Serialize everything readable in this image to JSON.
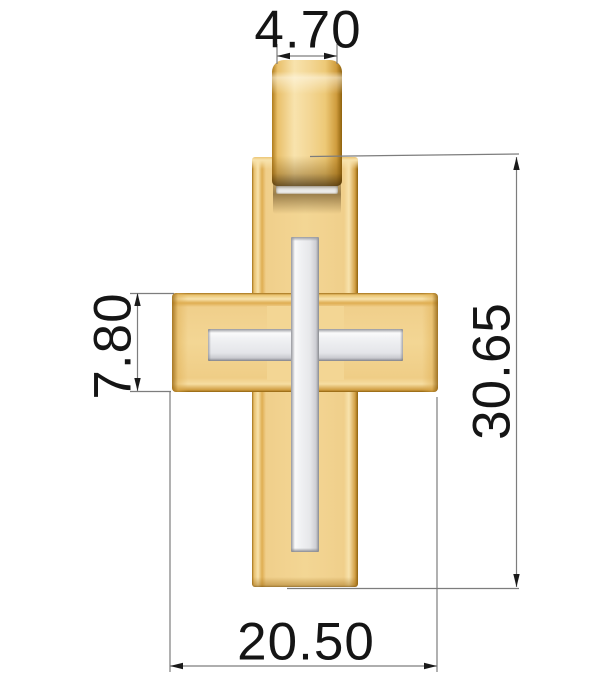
{
  "drawing": {
    "subject": "two-tone-cross-pendant",
    "parts": [
      "bail",
      "gold-cross-vertical-bar",
      "gold-cross-horizontal-bar",
      "white-metal-inlay-cross",
      "bail-slot",
      "bail-hole"
    ]
  },
  "dimensions": {
    "bail_width": "4.70",
    "arm_height": "7.80",
    "total_height": "30.65",
    "cross_width": "20.50"
  },
  "colors": {
    "gold_base": "#F3D694",
    "gold_light": "#F8E3AD",
    "gold_mid": "#E9C06A",
    "gold_dark": "#A1701A",
    "gold_deep": "#8F620C",
    "white_metal": "#F1F2F4",
    "white_metal_edge": "#8F9096",
    "dim_text": "#151515",
    "dim_line": "#7D7D7D",
    "arrow": "#1A1A1A",
    "bg": "#FFFFFF"
  }
}
